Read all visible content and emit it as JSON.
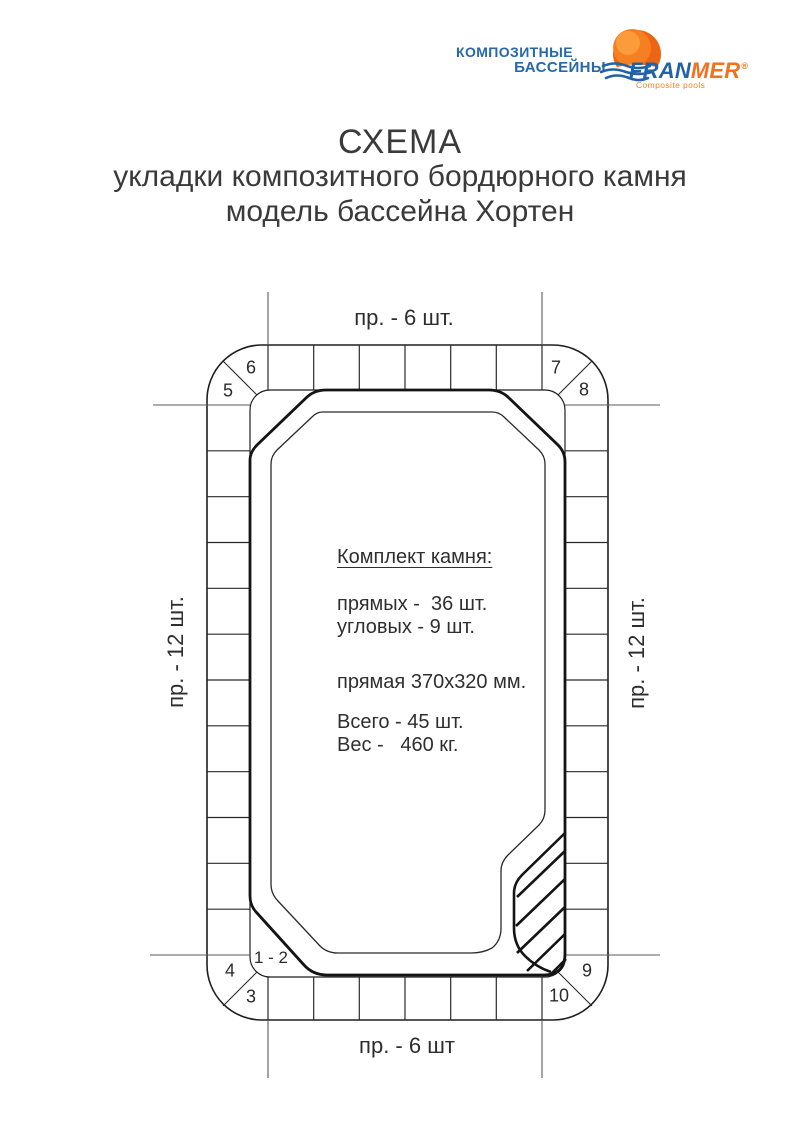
{
  "logo": {
    "brand_line1": "КОМПОЗИТНЫЕ",
    "brand_line2": "БАССЕЙНЫ",
    "name_blue": "FRAN",
    "name_orange": "MER",
    "registered": "®",
    "tagline": "Composite pools",
    "colors": {
      "blue": "#2263a8",
      "orange": "#f1711f"
    }
  },
  "title": {
    "line1": "СХЕМА",
    "line2": "укладки композитного бордюрного камня",
    "line3": "модель бассейна Хортен"
  },
  "diagram": {
    "top_label": "пр. - 6 шт.",
    "bottom_label": "пр. - 6 шт",
    "left_label": "пр. - 12 шт.",
    "right_label": "пр. - 12 шт.",
    "numbers": {
      "pair": "1 - 2",
      "n3": "3",
      "n4": "4",
      "n5": "5",
      "n6": "6",
      "n7": "7",
      "n8": "8",
      "n9": "9",
      "n10": "10"
    }
  },
  "kit": {
    "heading": "Комплект камня:",
    "straight": "прямых -  36 шт.",
    "corner": "угловых - 9 шт.",
    "size": "прямая 370х320 мм.",
    "total": "Всего - 45 шт.",
    "weight": "Вес -   460 кг."
  }
}
